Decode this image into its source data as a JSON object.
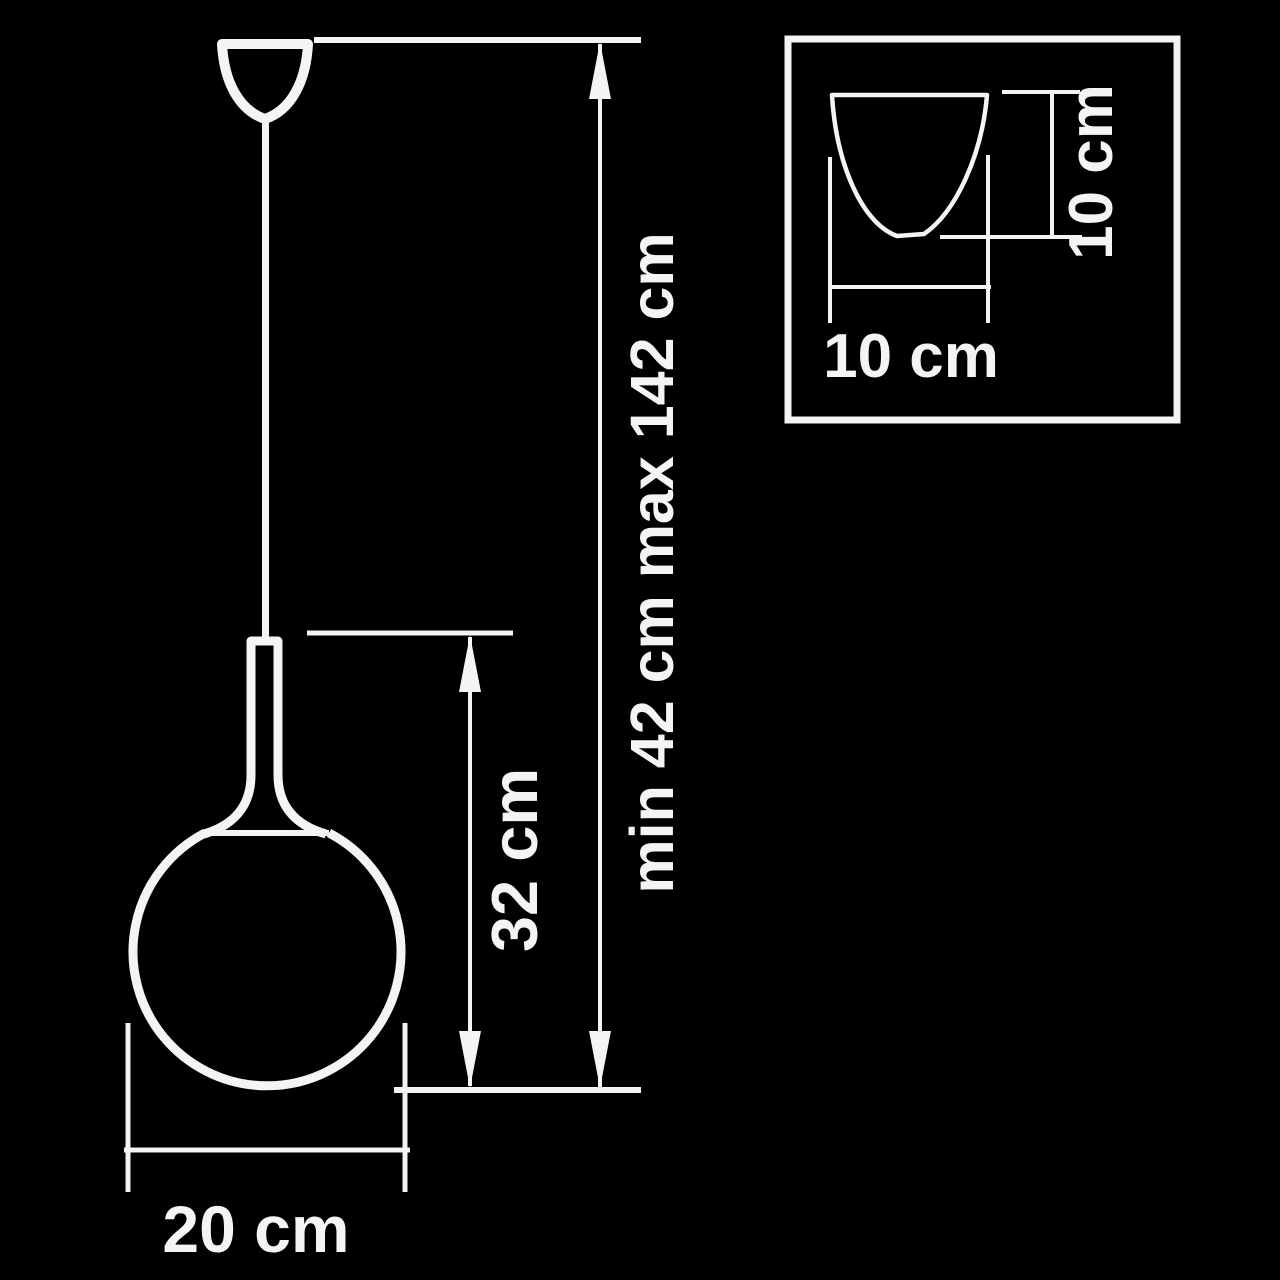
{
  "page": {
    "background_color": "#000000",
    "line_color": "#f4f4f4"
  },
  "diagram": {
    "labels": {
      "overall_height": "min 42 cm max 142 cm",
      "body_height": "32 cm",
      "sphere_diameter": "20 cm",
      "inset_canopy_width": "10 cm",
      "inset_canopy_height": "10 cm"
    }
  }
}
